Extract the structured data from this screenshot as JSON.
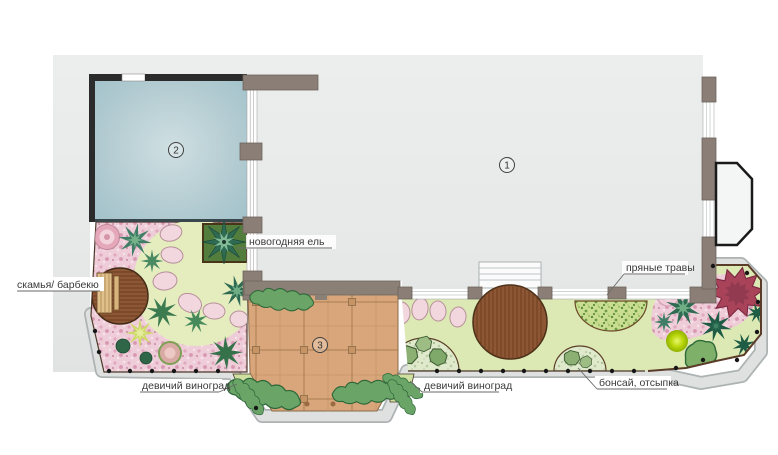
{
  "labels": {
    "bench": "скамья/ барбекю",
    "spruce": "новогодняя ель",
    "grapes_left": "девичий виноград",
    "grapes_center": "девичий виноград",
    "herbs": "пряные травы",
    "bonsai": "бонсай, отсыпка"
  },
  "markers": {
    "house": "1",
    "terrace": "2",
    "pergola": "3"
  },
  "colors": {
    "site_gray": "#e7e9e9",
    "terrace_blue": "#a9c6cd",
    "lawn_green": "#dfe8b2",
    "flower_pink": "#eecdd8",
    "deck_wood": "#8d5634",
    "pergola_wood": "#d8a67a",
    "wall_gray": "#8a7e76",
    "wall_dark": "#2b2b2b",
    "walkway_gray": "#dfe1e1",
    "spruce_bed_green": "#527d3d",
    "red_bush": "#a8435a",
    "accent_lime": "#b8d609"
  }
}
